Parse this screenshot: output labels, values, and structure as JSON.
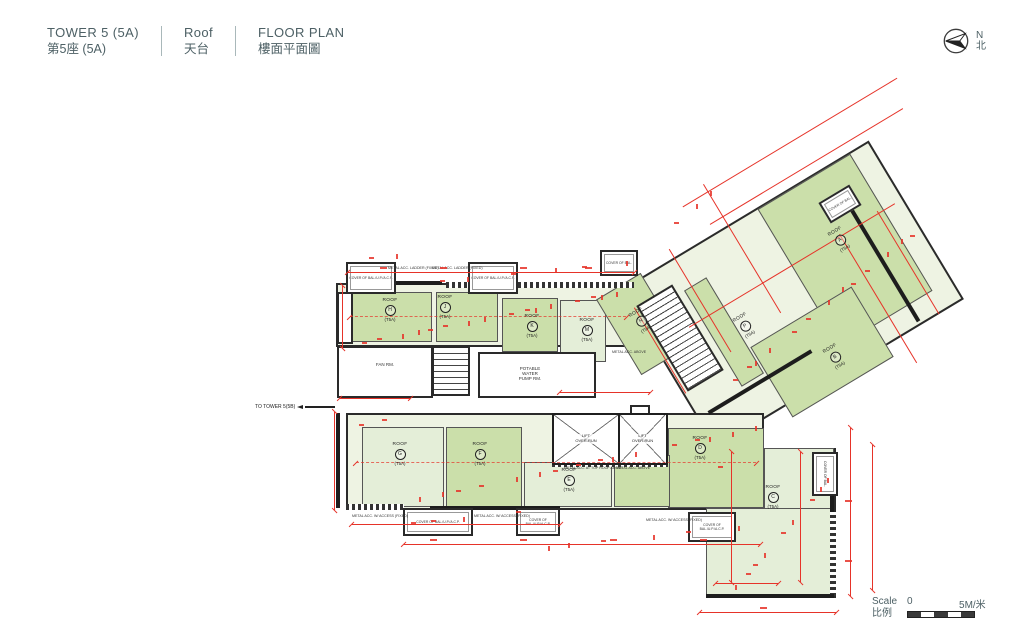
{
  "header": {
    "tower_en": "TOWER 5 (5A)",
    "tower_zh": "第5座 (5A)",
    "level_en": "Roof",
    "level_zh": "天台",
    "plan_en": "FLOOR PLAN",
    "plan_zh": "樓面平面圖"
  },
  "compass": {
    "north_en": "N",
    "north_zh": "北"
  },
  "scale_bar": {
    "label_en": "Scale",
    "label_zh": "比例",
    "start": "0",
    "end": "5M/米"
  },
  "plan": {
    "roof_word": "ROOF",
    "unit": "(T5A)",
    "roofs": [
      {
        "letter": "A"
      },
      {
        "letter": "B"
      },
      {
        "letter": "C"
      },
      {
        "letter": "D"
      },
      {
        "letter": "E"
      },
      {
        "letter": "F"
      },
      {
        "letter": "G"
      },
      {
        "letter": "H"
      },
      {
        "letter": "J"
      },
      {
        "letter": "K"
      },
      {
        "letter": "M"
      },
      {
        "letter": "N"
      },
      {
        "letter": "P"
      }
    ],
    "labels": {
      "to_tower": "TO TOWER 5(5B)",
      "fan_rm": "FAN RM.",
      "pump_rm_1": "POTABLE",
      "pump_rm_2": "WATER",
      "pump_rm_3": "PUMP RM.",
      "lift_1": "LIFT",
      "lift_2": "OVER-RUN",
      "cover_full": "COVER OF BAL./U.P./A.C.P.",
      "cover_short": "COVER OF BAL.",
      "metal_ladder": "METAL ACC. LADDER (FIXED)",
      "metal_access": "METAL ACC. W/ ACCESS (FIXED)",
      "metal_top": "METAL ACC. AT TOP ROOF ABOVE",
      "metal_above": "METAL ACC. ABOVE"
    },
    "colors": {
      "roof_green_dark": "#cbdfaa",
      "roof_green_light": "#e4eed8",
      "dimension_red": "#e63329"
    }
  }
}
